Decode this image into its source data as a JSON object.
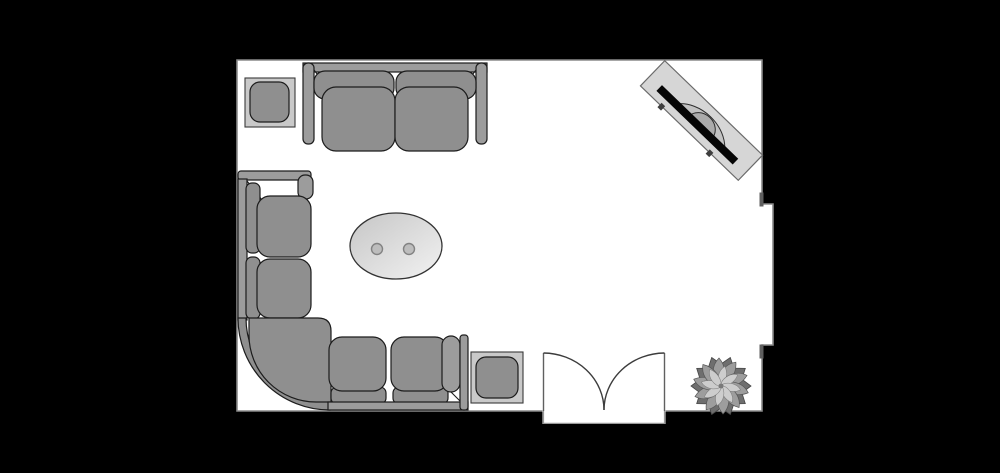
{
  "scene": {
    "kind": "floor-plan",
    "room_shape": "rectangular room with right-wall opening and bottom double door"
  },
  "colors": {
    "background": "#000000",
    "floor": "#ffffff",
    "wall-line": "#8a8a8a",
    "door-line": "#3c3c3c",
    "sofa-fill": "#8f8f8f",
    "sofa-frame": "#9c9c9c",
    "sofa-stroke": "#1c1c1c",
    "table-outer": "#c9c9c9",
    "table-inner": "#8f8f8f",
    "oval-light": "#f2f2f2",
    "oval-dark": "#c6c6c6",
    "knob": "#bdbdbd",
    "tv-cabinet": "#d6d6d6",
    "tv-back": "#c2c2c2",
    "tv-screen": "#060606",
    "plant-dark": "#6e6e6e",
    "plant-mid": "#9d9d9d",
    "plant-light": "#cdcdcd"
  },
  "furniture": {
    "loveseat": "two-seat sofa",
    "sectional": "corner sectional sofa",
    "coffee_table": "oval coffee table",
    "side_table_top": "square side table",
    "side_table_bottom": "square side table",
    "tv": "TV on media stand (rotated 44 degrees)",
    "plant": "potted plant",
    "door": "double swing door",
    "opening": "wall opening / recess"
  }
}
